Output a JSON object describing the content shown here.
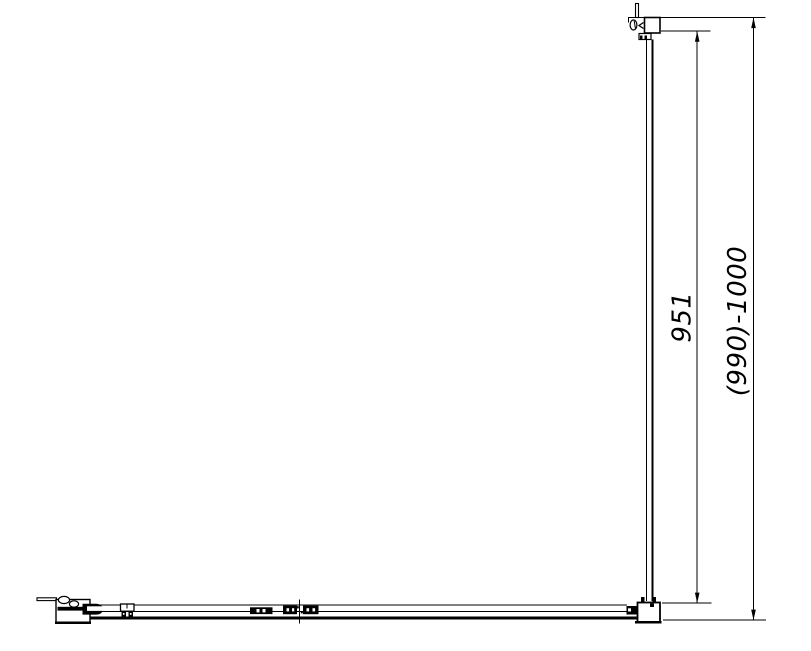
{
  "drawing": {
    "dimensions": {
      "panel_width": {
        "label": "951"
      },
      "overall_width": {
        "label": "(990)-1000"
      }
    },
    "colors": {
      "line": "#000000",
      "background": "#ffffff"
    }
  }
}
